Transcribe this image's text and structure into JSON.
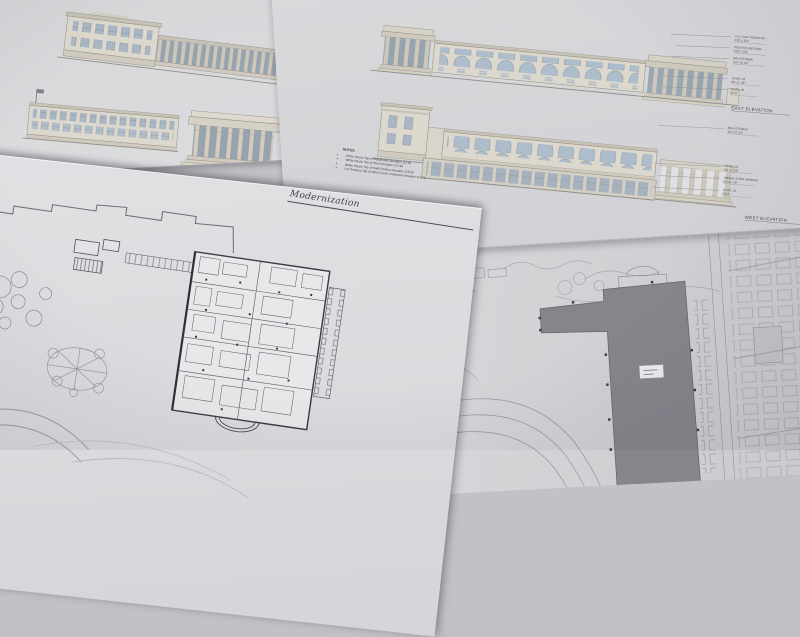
{
  "colors": {
    "paper": "#dcdcdf",
    "paper_dark": "#cfcfd3",
    "background": "#c2c2c6",
    "line_dark": "#3a3b40",
    "line_medium": "#6a6a70",
    "line_light": "#9a9aa0",
    "wall_tan": "#dcd8cd",
    "trim_tan": "#c7c2b6",
    "window_blue": "#a9b6c3",
    "arch_blue": "#aebdcb",
    "shadow_void": "#97a3af",
    "footprint_gray": "#85868c",
    "accent_red": "#a3524c"
  },
  "notes": {
    "heading": "NOTES:",
    "items": [
      "White House Top of Balustrade elevation 113.81",
      "White House Top of Roof elevation 122.98",
      "White House Top of North Portico elevation 115.92",
      "US Treasury Top of West Center Pediment elevation 113.76"
    ]
  },
  "plan_sheet_left": {
    "title_fragment": "Modernization"
  },
  "annotations": {
    "east_caption": "EAST ELEVATION",
    "west_caption": "WEST ELEVATION",
    "east_upper": [
      {
        "label": "T.O. LIGHT MONITOR",
        "elev": "130'-1 3/4\""
      },
      {
        "label": "PENTHOUSE ROOF",
        "elev": "119'-1 1/8\""
      },
      {
        "label": "BALUSTRADE",
        "elev": "113'-10 1/2\""
      }
    ],
    "east_lower": [
      {
        "label": "LEVEL 03",
        "elev": "68'-11 1/8\""
      },
      {
        "label": "LEVEL 02",
        "elev": "52'-0\""
      }
    ],
    "west_upper": [
      {
        "label": "BALUSTRADE",
        "elev": "113'-10 1/2\""
      }
    ],
    "west_lower": [
      {
        "label": "LEVEL 03",
        "elev": "68'-11 1/8\""
      },
      {
        "label": "GRAND STAIR LANDING",
        "elev": "59'-11 1/8\""
      },
      {
        "label": "LEVEL 02",
        "elev": "52'-0\""
      }
    ]
  }
}
